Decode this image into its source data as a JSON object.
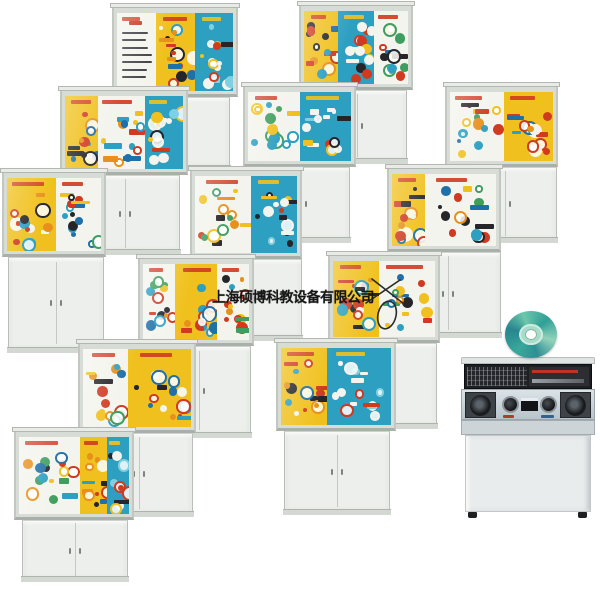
{
  "watermark": {
    "text": "上海硕博科教设备有限公司",
    "x": 212,
    "y": 287
  },
  "palette": {
    "yellow": "#f0c11e",
    "teal": "#2d9fc1",
    "white": "#f4f4ee",
    "red": "#cf3a21",
    "blue": "#1f6fa8",
    "orange": "#e8901c",
    "black": "#26262a",
    "green": "#3f9e5f",
    "light_teal": "#7fd0e0",
    "frame": "#d7dcd6",
    "base": "#ecefeb"
  },
  "cabinets": [
    {
      "id": "intro-sewing-machines",
      "z": 1,
      "seed": 11,
      "box": [
        112,
        4,
        126,
        93
      ],
      "base": [
        122,
        97,
        108,
        74
      ],
      "panels": [
        {
          "c": "white",
          "w": 0.34,
          "text": true
        },
        {
          "c": "yellow",
          "w": 0.33
        },
        {
          "c": "teal",
          "w": 0.33
        }
      ]
    },
    {
      "id": "disc-mechanisms",
      "z": 1,
      "seed": 22,
      "box": [
        299,
        2,
        114,
        88
      ],
      "base": [
        307,
        90,
        100,
        74
      ],
      "panels": [
        {
          "c": "yellow",
          "w": 0.33
        },
        {
          "c": "teal",
          "w": 0.34
        },
        {
          "c": "white",
          "w": 0.33
        }
      ]
    },
    {
      "id": "machine-models",
      "z": 2,
      "seed": 33,
      "box": [
        60,
        87,
        128,
        88
      ],
      "base": [
        70,
        175,
        110,
        80
      ],
      "panels": [
        {
          "c": "yellow",
          "w": 0.28
        },
        {
          "c": "white",
          "w": 0.4
        },
        {
          "c": "teal",
          "w": 0.32
        }
      ]
    },
    {
      "id": "belt-drives",
      "z": 2,
      "seed": 44,
      "box": [
        243,
        83,
        113,
        84
      ],
      "base": [
        252,
        167,
        98,
        76
      ],
      "panels": [
        {
          "c": "white",
          "w": 0.5
        },
        {
          "c": "teal",
          "w": 0.5
        }
      ]
    },
    {
      "id": "couplings",
      "z": 2,
      "seed": 55,
      "box": [
        445,
        83,
        113,
        84
      ],
      "base": [
        453,
        167,
        104,
        76
      ],
      "panels": [
        {
          "c": "white",
          "w": 0.52
        },
        {
          "c": "yellow",
          "w": 0.48
        }
      ]
    },
    {
      "id": "piston-mechanisms",
      "z": 3,
      "seed": 66,
      "box": [
        2,
        169,
        104,
        88
      ],
      "base": [
        8,
        257,
        96,
        96
      ],
      "panels": [
        {
          "c": "yellow",
          "w": 0.52
        },
        {
          "c": "white",
          "w": 0.48
        }
      ]
    },
    {
      "id": "chain-drives",
      "z": 3,
      "seed": 77,
      "box": [
        190,
        167,
        112,
        92
      ],
      "base": [
        198,
        259,
        104,
        82
      ],
      "panels": [
        {
          "c": "white",
          "w": 0.55
        },
        {
          "c": "teal",
          "w": 0.45
        }
      ]
    },
    {
      "id": "threaded-fasteners",
      "z": 3,
      "seed": 88,
      "box": [
        387,
        165,
        114,
        87
      ],
      "base": [
        395,
        252,
        106,
        86
      ],
      "panels": [
        {
          "c": "yellow",
          "w": 0.32
        },
        {
          "c": "white",
          "w": 0.68
        }
      ]
    },
    {
      "id": "gear-mechanisms",
      "z": 4,
      "seed": 99,
      "box": [
        138,
        255,
        116,
        91
      ],
      "base": [
        147,
        346,
        104,
        92
      ],
      "panels": [
        {
          "c": "white",
          "w": 0.3
        },
        {
          "c": "yellow",
          "w": 0.4
        },
        {
          "c": "white",
          "w": 0.3
        }
      ]
    },
    {
      "id": "small-parts",
      "z": 4,
      "seed": 111,
      "box": [
        328,
        252,
        112,
        91
      ],
      "base": [
        337,
        343,
        100,
        86
      ],
      "panels": [
        {
          "c": "yellow",
          "w": 0.45
        },
        {
          "c": "white",
          "w": 0.55
        }
      ]
    },
    {
      "id": "pulley-models",
      "z": 5,
      "seed": 122,
      "box": [
        78,
        340,
        118,
        93
      ],
      "base": [
        85,
        433,
        108,
        84
      ],
      "panels": [
        {
          "c": "white",
          "w": 0.42
        },
        {
          "c": "yellow",
          "w": 0.58
        }
      ]
    },
    {
      "id": "valve-fittings",
      "z": 5,
      "seed": 133,
      "box": [
        276,
        339,
        120,
        92
      ],
      "base": [
        284,
        431,
        106,
        84
      ],
      "panels": [
        {
          "c": "yellow",
          "w": 0.42
        },
        {
          "c": "teal",
          "w": 0.58
        }
      ]
    },
    {
      "id": "magnetic-models",
      "z": 6,
      "seed": 144,
      "box": [
        14,
        428,
        120,
        92
      ],
      "base": [
        22,
        520,
        106,
        62
      ],
      "panels": [
        {
          "c": "white",
          "w": 0.55
        },
        {
          "c": "yellow",
          "w": 0.25
        },
        {
          "c": "teal",
          "w": 0.2
        }
      ]
    }
  ],
  "cd": {
    "x": 505,
    "y": 311,
    "w": 52,
    "h": 47
  },
  "console": {
    "x": 461,
    "y": 357,
    "w": 134,
    "h": 165
  },
  "scribble": {
    "x": 360,
    "y": 273,
    "w": 48,
    "h": 58
  }
}
